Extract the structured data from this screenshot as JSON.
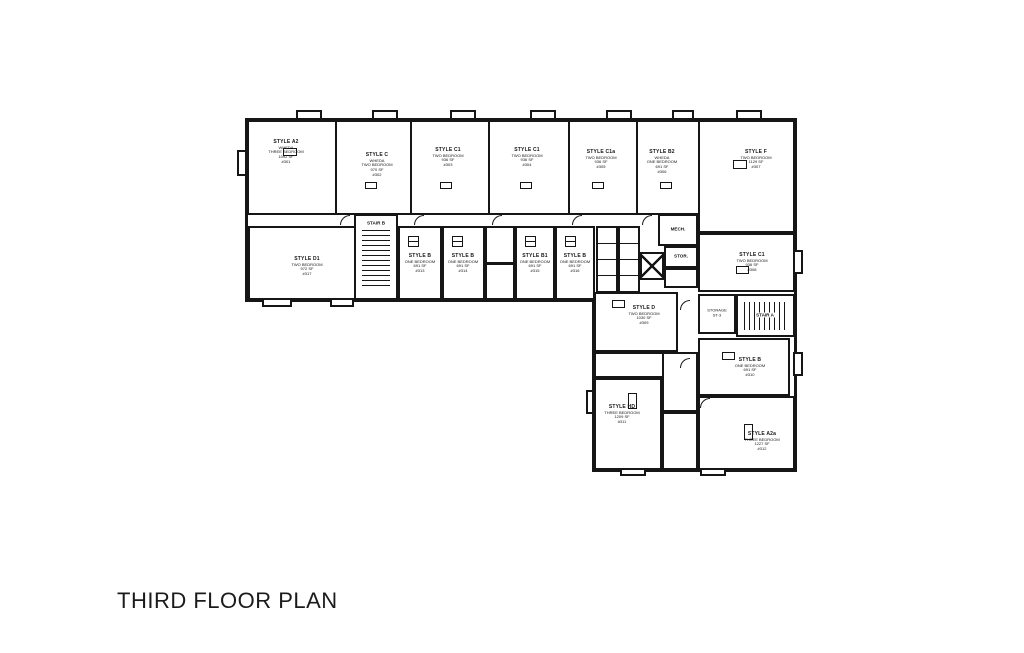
{
  "title": "THIRD FLOOR PLAN",
  "colors": {
    "ink": "#161616",
    "paper": "#ffffff"
  },
  "units": {
    "a2": {
      "style": "STYLE A2",
      "program": "WHEDA",
      "beds": "THREE BEDROOM",
      "area": "1092 SF",
      "number": "#301"
    },
    "c": {
      "style": "STYLE C",
      "program": "WHEDA",
      "beds": "TWO BEDROOM",
      "area": "970 SF",
      "number": "#302"
    },
    "c1_1": {
      "style": "STYLE C1",
      "beds": "TWO BEDROOM",
      "area": "936 SF",
      "number": "#303"
    },
    "c1_2": {
      "style": "STYLE C1",
      "beds": "TWO BEDROOM",
      "area": "936 SF",
      "number": "#304"
    },
    "c1a": {
      "style": "STYLE C1a",
      "beds": "TWO BEDROOM",
      "area": "936 SF",
      "number": "#305"
    },
    "b2": {
      "style": "STYLE B2",
      "program": "WHEDA",
      "beds": "ONE BEDROOM",
      "area": "691 SF",
      "number": "#306"
    },
    "f": {
      "style": "STYLE F",
      "beds": "TWO BEDROOM",
      "area": "1129 SF",
      "number": "#307"
    },
    "c1_3": {
      "style": "STYLE C1",
      "beds": "TWO BEDROOM",
      "area": "936 SF",
      "number": "#308"
    },
    "d": {
      "style": "STYLE D",
      "beds": "TWO BEDROOM",
      "area": "1030 SF",
      "number": "#309"
    },
    "b_4": {
      "style": "STYLE B",
      "beds": "ONE BEDROOM",
      "area": "691 SF",
      "number": "#310"
    },
    "hd": {
      "style": "STYLE HD",
      "beds": "THREE BEDROOM",
      "area": "1209 SF",
      "number": "#311"
    },
    "a2a": {
      "style": "STYLE A2a",
      "beds": "THREE BEDROOM",
      "area": "1227 SF",
      "number": "#312"
    },
    "b_1": {
      "style": "STYLE B",
      "beds": "ONE BEDROOM",
      "area": "691 SF",
      "number": "#313"
    },
    "b_2": {
      "style": "STYLE B",
      "beds": "ONE BEDROOM",
      "area": "691 SF",
      "number": "#314"
    },
    "b1": {
      "style": "STYLE B1",
      "beds": "ONE BEDROOM",
      "area": "691 SF",
      "number": "#315"
    },
    "b_3": {
      "style": "STYLE B",
      "beds": "ONE BEDROOM",
      "area": "691 SF",
      "number": "#316"
    },
    "d1": {
      "style": "STYLE D1",
      "beds": "TWO BEDROOM",
      "area": "972 SF",
      "number": "#317"
    }
  },
  "core": {
    "stair_a": "STAIR A",
    "stair_b": "STAIR B",
    "mech": "MECH.",
    "stor": "STOR.",
    "storage": "STORAGE",
    "storage_id": "ST-3"
  }
}
